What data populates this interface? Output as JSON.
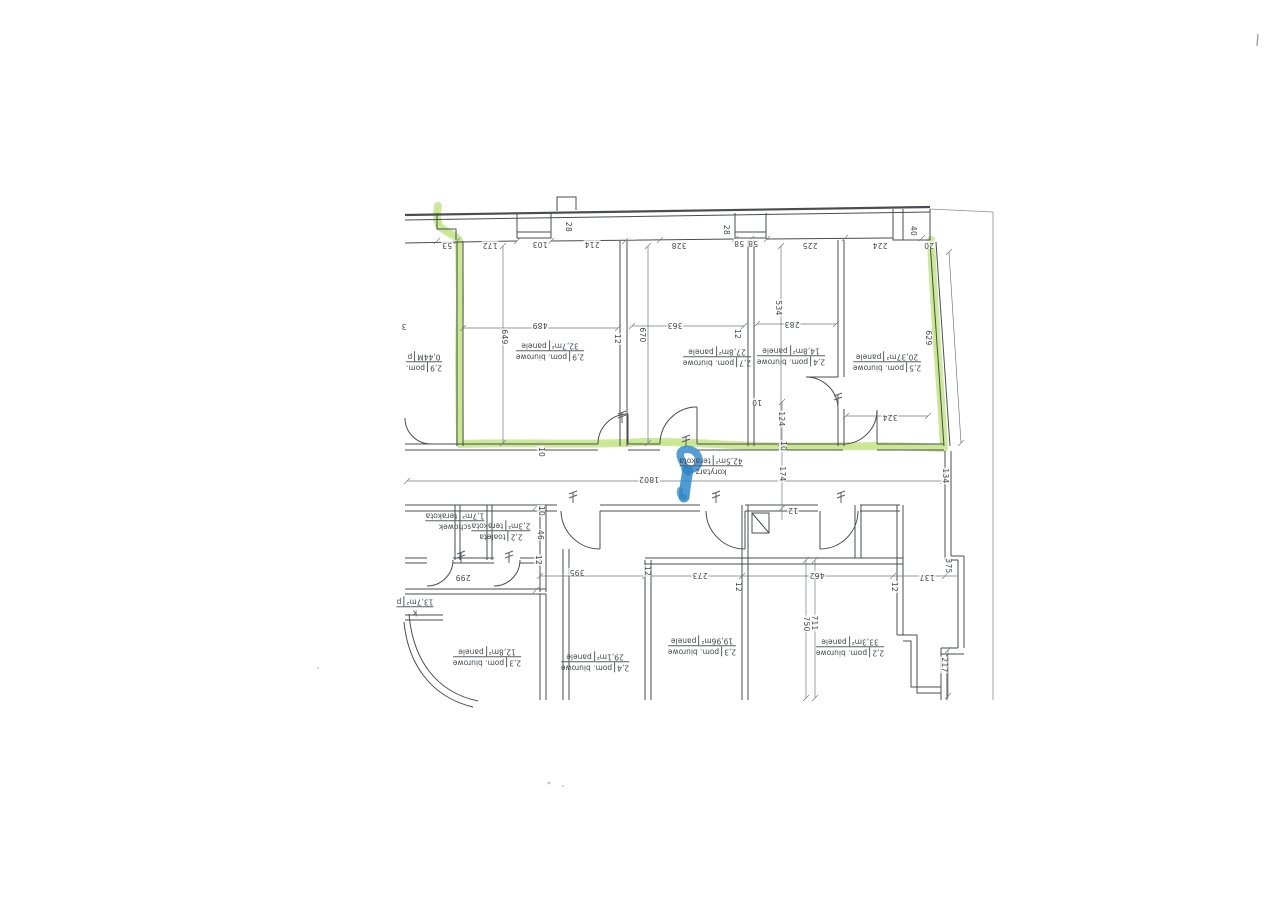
{
  "floor_plan": {
    "colors": {
      "highlighter_green": "#a6d650",
      "marker_blue": "#2b85c8",
      "wall_line": "#4a4c51"
    },
    "room_labels": [
      {
        "h": "2,9",
        "name": "pom. biurowe",
        "area": "32,7m²",
        "floor": "panele",
        "x": 550,
        "y": 351
      },
      {
        "h": "2,7",
        "name": "pom. biurowe",
        "area": "27,8m²",
        "floor": "panele",
        "x": 717,
        "y": 357
      },
      {
        "h": "2,4",
        "name": "pom. biurowe",
        "area": "14,8m²",
        "floor": "panele",
        "x": 791,
        "y": 356
      },
      {
        "h": "2,5",
        "name": "pom. biurowe",
        "area": "20,37m²",
        "floor": "panele",
        "x": 887,
        "y": 362
      },
      {
        "h": "",
        "name": "korytarz",
        "area": "42,5m²",
        "floor": "terakota",
        "x": 711,
        "y": 466
      },
      {
        "h": "2,2",
        "name": "toaleta",
        "area": "2,3m²",
        "floor": "terakota",
        "x": 501,
        "y": 531
      },
      {
        "h": "",
        "name": "schowek",
        "area": "1,7m²",
        "floor": "terakota",
        "x": 455,
        "y": 521
      },
      {
        "h": "2,3",
        "name": "pom. biurowe",
        "area": "12,8m²",
        "floor": "panele",
        "x": 487,
        "y": 657
      },
      {
        "h": "2,4",
        "name": "pom. biurowe",
        "area": "29,1m²",
        "floor": "panele",
        "x": 595,
        "y": 662
      },
      {
        "h": "2,3",
        "name": "pom. biurowe",
        "area": "19,96m²",
        "floor": "panele",
        "x": 702,
        "y": 646
      },
      {
        "h": "2,2",
        "name": "pom. biurowe",
        "area": "33,3m²",
        "floor": "panele",
        "x": 850,
        "y": 647
      },
      {
        "h": "2,9",
        "name": "pom.",
        "area": "0,44M",
        "floor": "p",
        "x": 424,
        "y": 362
      },
      {
        "h": "",
        "name": "k",
        "area": "13,7m²",
        "floor": "p",
        "x": 415,
        "y": 607
      }
    ],
    "dim_labels": [
      {
        "t": "53",
        "x": 447,
        "y": 245,
        "o": "h"
      },
      {
        "t": "172",
        "x": 490,
        "y": 245,
        "o": "h"
      },
      {
        "t": "103",
        "x": 540,
        "y": 244,
        "o": "h"
      },
      {
        "t": "214",
        "x": 592,
        "y": 244,
        "o": "h"
      },
      {
        "t": "328",
        "x": 679,
        "y": 245,
        "o": "h"
      },
      {
        "t": "58",
        "x": 739,
        "y": 243,
        "o": "h"
      },
      {
        "t": "58",
        "x": 753,
        "y": 243,
        "o": "h"
      },
      {
        "t": "225",
        "x": 810,
        "y": 245,
        "o": "h"
      },
      {
        "t": "224",
        "x": 880,
        "y": 245,
        "o": "h"
      },
      {
        "t": "20",
        "x": 929,
        "y": 245,
        "o": "h"
      },
      {
        "t": "28",
        "x": 568,
        "y": 227,
        "o": "v"
      },
      {
        "t": "28",
        "x": 726,
        "y": 230,
        "o": "v"
      },
      {
        "t": "40",
        "x": 913,
        "y": 231,
        "o": "v"
      },
      {
        "t": "649",
        "x": 504,
        "y": 337,
        "o": "v"
      },
      {
        "t": "489",
        "x": 540,
        "y": 325,
        "o": "h"
      },
      {
        "t": "670",
        "x": 642,
        "y": 335,
        "o": "v"
      },
      {
        "t": "12",
        "x": 617,
        "y": 339,
        "o": "v"
      },
      {
        "t": "363",
        "x": 675,
        "y": 325,
        "o": "h"
      },
      {
        "t": "534",
        "x": 778,
        "y": 308,
        "o": "v"
      },
      {
        "t": "283",
        "x": 792,
        "y": 324,
        "o": "h"
      },
      {
        "t": "12",
        "x": 737,
        "y": 334,
        "o": "v"
      },
      {
        "t": "629",
        "x": 928,
        "y": 338,
        "o": "v"
      },
      {
        "t": "324",
        "x": 890,
        "y": 417,
        "o": "h"
      },
      {
        "t": "124",
        "x": 781,
        "y": 419,
        "o": "v"
      },
      {
        "t": "10",
        "x": 783,
        "y": 446,
        "o": "v"
      },
      {
        "t": "174",
        "x": 782,
        "y": 474,
        "o": "v"
      },
      {
        "t": "12",
        "x": 793,
        "y": 510,
        "o": "h"
      },
      {
        "t": "1802",
        "x": 649,
        "y": 479,
        "o": "h"
      },
      {
        "t": "134",
        "x": 945,
        "y": 476,
        "o": "v"
      },
      {
        "t": "10",
        "x": 757,
        "y": 402,
        "o": "h"
      },
      {
        "t": "10",
        "x": 541,
        "y": 452,
        "o": "v"
      },
      {
        "t": "10",
        "x": 541,
        "y": 511,
        "o": "v"
      },
      {
        "t": "46",
        "x": 540,
        "y": 535,
        "o": "v"
      },
      {
        "t": "12",
        "x": 538,
        "y": 560,
        "o": "v"
      },
      {
        "t": "299",
        "x": 463,
        "y": 577,
        "o": "h"
      },
      {
        "t": "395",
        "x": 577,
        "y": 572,
        "o": "h"
      },
      {
        "t": "12",
        "x": 647,
        "y": 571,
        "o": "v"
      },
      {
        "t": "273",
        "x": 700,
        "y": 575,
        "o": "h"
      },
      {
        "t": "12",
        "x": 738,
        "y": 587,
        "o": "v"
      },
      {
        "t": "462",
        "x": 817,
        "y": 575,
        "o": "h"
      },
      {
        "t": "12",
        "x": 894,
        "y": 587,
        "o": "v"
      },
      {
        "t": "137",
        "x": 927,
        "y": 577,
        "o": "h"
      },
      {
        "t": "375",
        "x": 948,
        "y": 566,
        "o": "v"
      },
      {
        "t": "750",
        "x": 806,
        "y": 624,
        "o": "v"
      },
      {
        "t": "711",
        "x": 814,
        "y": 623,
        "o": "v"
      },
      {
        "t": "217",
        "x": 944,
        "y": 665,
        "o": "v"
      },
      {
        "t": "3",
        "x": 404,
        "y": 326,
        "o": "h"
      }
    ]
  }
}
